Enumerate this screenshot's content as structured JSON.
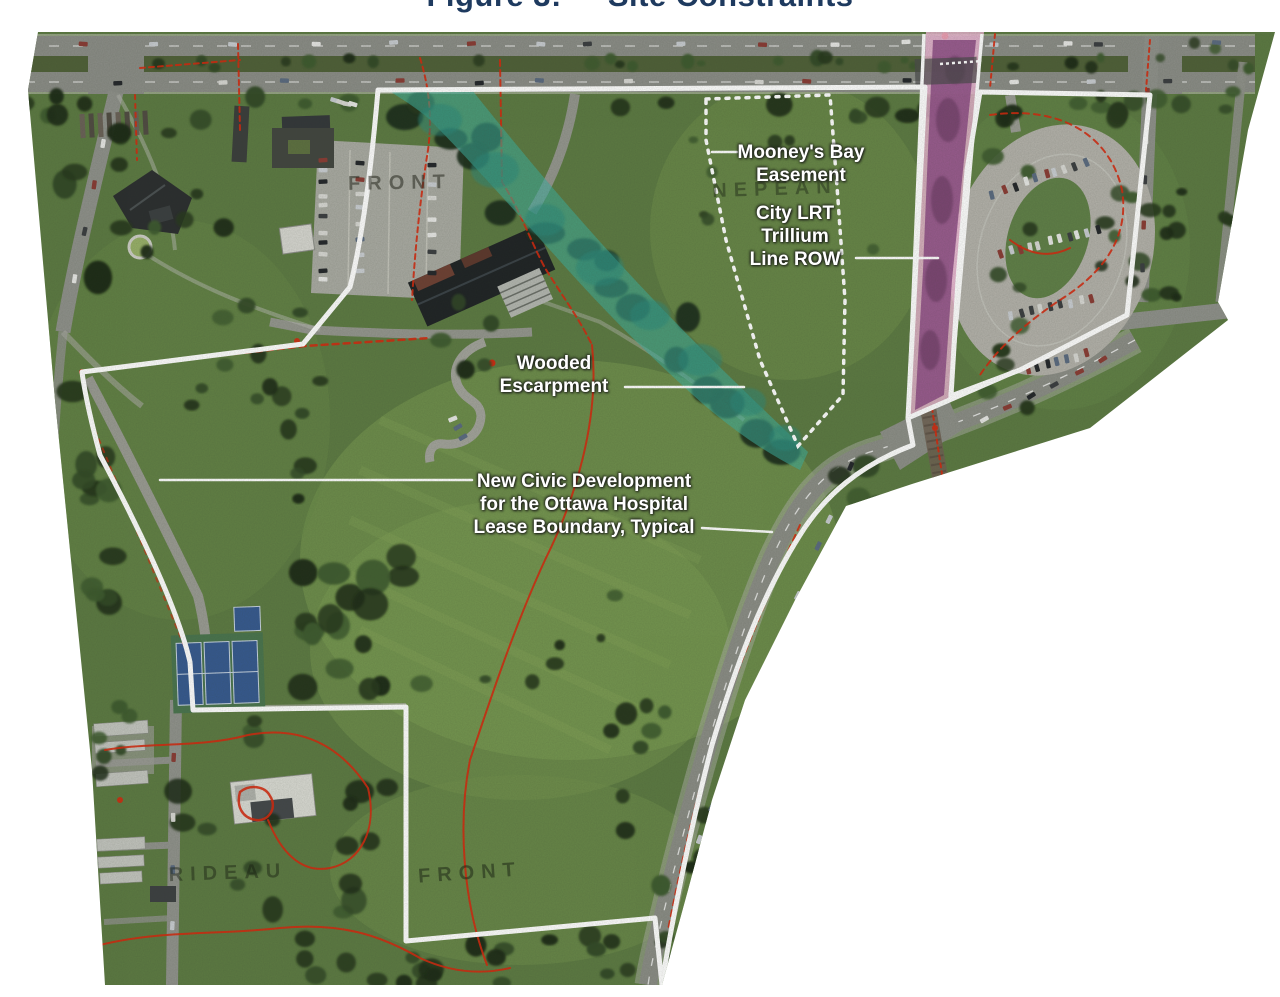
{
  "figure": {
    "title_prefix": "Figure 3:",
    "title_name": "Site Constraints",
    "title_color": "#1e3a5f"
  },
  "map": {
    "annotations": [
      {
        "id": "mooneys-bay-easement",
        "lines": [
          "Mooney's Bay",
          "Easement"
        ]
      },
      {
        "id": "city-lrt-trillium-row",
        "lines": [
          "City LRT",
          "Trillium",
          "Line ROW"
        ]
      },
      {
        "id": "wooded-escarpment",
        "lines": [
          "Wooded",
          "Escarpment"
        ]
      },
      {
        "id": "lease-boundary",
        "lines": [
          "New Civic Development",
          "for the Ottawa Hospital",
          "Lease Boundary, Typical"
        ]
      }
    ],
    "basemap_labels": [
      {
        "id": "front-upper",
        "text": "FRONT"
      },
      {
        "id": "nepean",
        "text": "NEPEAN"
      },
      {
        "id": "front-lower",
        "text": "FRONT"
      },
      {
        "id": "rideau",
        "text": "RIDEAU"
      }
    ],
    "legend_colors": {
      "lease_boundary_line": "#ffffff",
      "easement_boundary_line": "#ffffff",
      "wooded_escarpment_overlay": "#3db3a2",
      "lrt_corridor_fill": "#8f4f86",
      "lrt_corridor_edge": "#f3b9da",
      "contour_line": "#d6280d"
    }
  }
}
